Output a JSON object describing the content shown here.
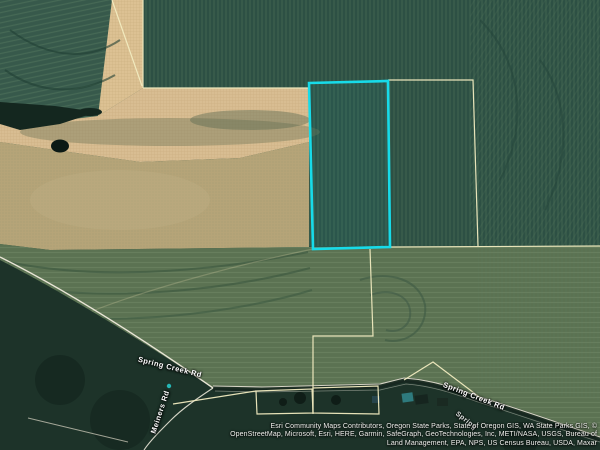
{
  "map": {
    "selected_parcel": {
      "outline_color": "#17dbe9"
    },
    "boundary_color": "#f2ecc0",
    "marker_color": "#27c4c4",
    "road_labels": {
      "spring_creek_west": "Spring Creek Rd",
      "spring_creek_east": "Spring Creek Rd",
      "meiners": "Meiners Rd",
      "partial": "Spring"
    }
  },
  "attribution": {
    "line1": "Esri Community Maps Contributors, Oregon State Parks, State of Oregon GIS, WA State Parks GIS, ©",
    "line2": "OpenStreetMap, Microsoft, Esri, HERE, Garmin, SafeGraph, GeoTechnologies, Inc, METI/NASA, USGS, Bureau of",
    "line3": "Land Management, EPA, NPS, US Census Bureau, USDA, Maxar"
  }
}
